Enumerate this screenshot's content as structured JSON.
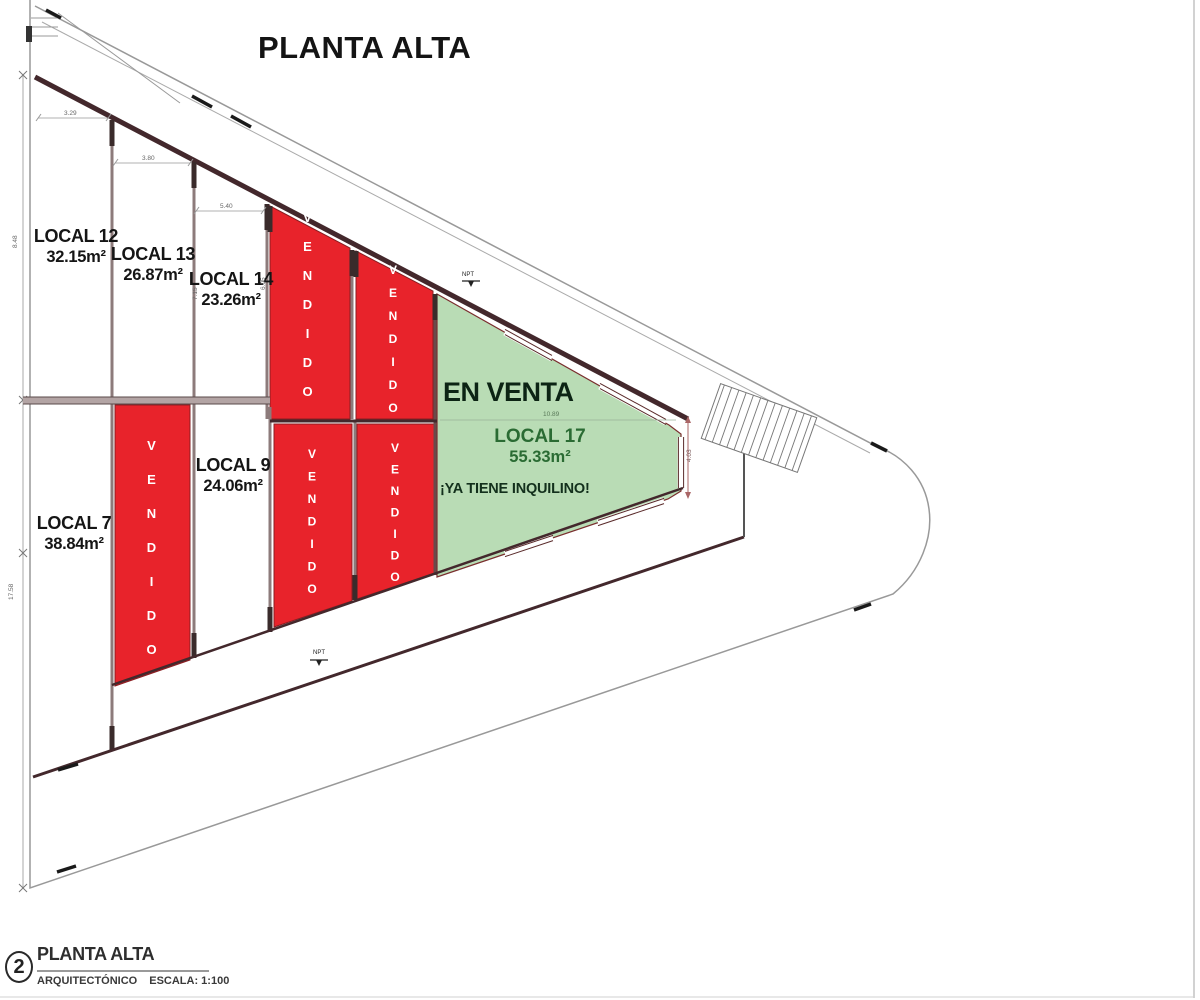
{
  "title": "PLANTA ALTA",
  "plan": {
    "sold_label": "VENDIDO",
    "for_sale_banner": "EN VENTA",
    "units": [
      {
        "name": "LOCAL 12",
        "area": "32.15m²",
        "status": "disponible"
      },
      {
        "name": "LOCAL 13",
        "area": "26.87m²",
        "status": "disponible"
      },
      {
        "name": "LOCAL 14",
        "area": "23.26m²",
        "status": "disponible"
      },
      {
        "name": "LOCAL 9",
        "area": "24.06m²",
        "status": "disponible"
      },
      {
        "name": "LOCAL 7",
        "area": "38.84m²",
        "status": "disponible"
      },
      {
        "name": "LOCAL 17",
        "area": "55.33m²",
        "status": "en venta",
        "note": "¡YA TIENE INQUILINO!"
      }
    ]
  },
  "dimensions": {
    "local12_front": "3.29",
    "local13_front": "3.80",
    "local14_front": "5.40",
    "local13_depth": "7.15",
    "local14_depth": "6.05",
    "local17_width": "10.89",
    "local17_height": "4.03",
    "left_upper": "8.48",
    "left_lower": "17.58",
    "level_marker": "NPT"
  },
  "title_block": {
    "sheet_number": "2",
    "sheet_name": "PLANTA ALTA",
    "discipline": "ARQUITECTÓNICO",
    "scale_label": "ESCALA: 1:100"
  },
  "colors": {
    "sold_fill": "#e8232b",
    "for_sale_fill": "#b9dcb5",
    "wall": "#43282c",
    "boundary": "#999999"
  }
}
